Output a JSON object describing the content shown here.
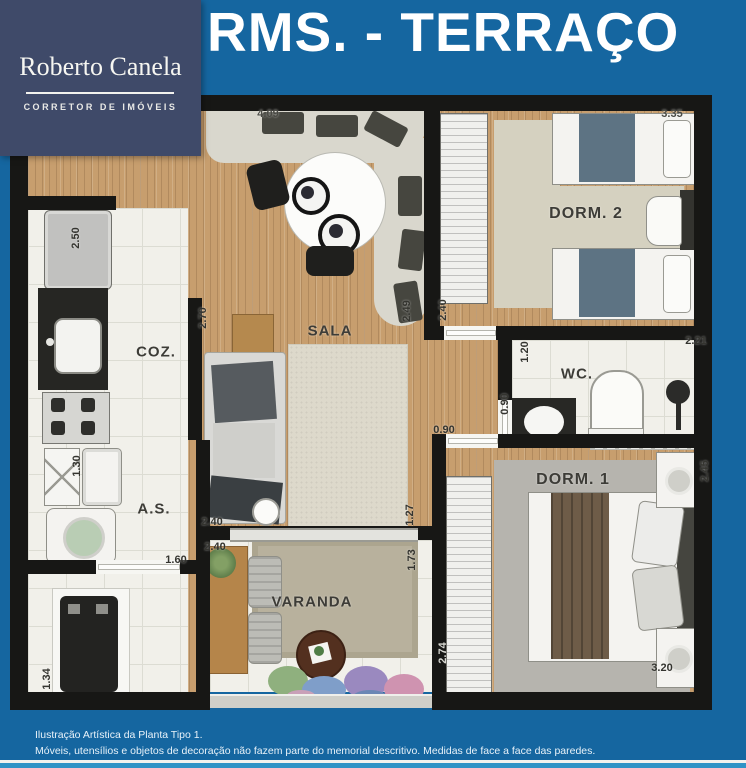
{
  "logo": {
    "name": "Roberto Canela",
    "tagline": "CORRETOR DE IMÓVEIS"
  },
  "title": "RMS. - TERRAÇO",
  "rooms": {
    "dorm2": "DORM. 2",
    "sala": "SALA",
    "coz": "COZ.",
    "wc": "WC.",
    "as": "A.S.",
    "dorm1": "DORM. 1",
    "varanda": "VARANDA"
  },
  "measurements": {
    "terrace_width": "4.09",
    "dorm2_width": "3.35",
    "kitchen_depth": "2.50",
    "kitchen_wall": "2.70",
    "sala_width": "2.49",
    "dorm2_depth": "2.40",
    "wc_depth": "1.20",
    "wc_width": "2.21",
    "wc_door": "0.90",
    "dorm1_door": "0.90",
    "as_depth": "1.30",
    "as_door": "1.60",
    "sala_length": "2.40",
    "varanda_top": "2.40",
    "hall_depth": "1.27",
    "varanda_right": "1.73",
    "varanda_side": "2.74",
    "storage_depth": "1.34",
    "dorm1_depth": "2.45",
    "dorm1_width": "3.20"
  },
  "footer": {
    "line1": "Ilustração Artística da Planta Tipo 1.",
    "line2": "Móveis, utensílios e objetos de decoração não fazem parte do memorial descritivo. Medidas de face a face das paredes."
  },
  "colors": {
    "background_blue": "#1566a0",
    "bottom_strip_blue": "#2f93c6",
    "logo_navy": "#3f4a69",
    "wall_black": "#171715",
    "wood": "#c79e6e",
    "tile": "#f1f0ea",
    "title_white": "#ffffff"
  }
}
